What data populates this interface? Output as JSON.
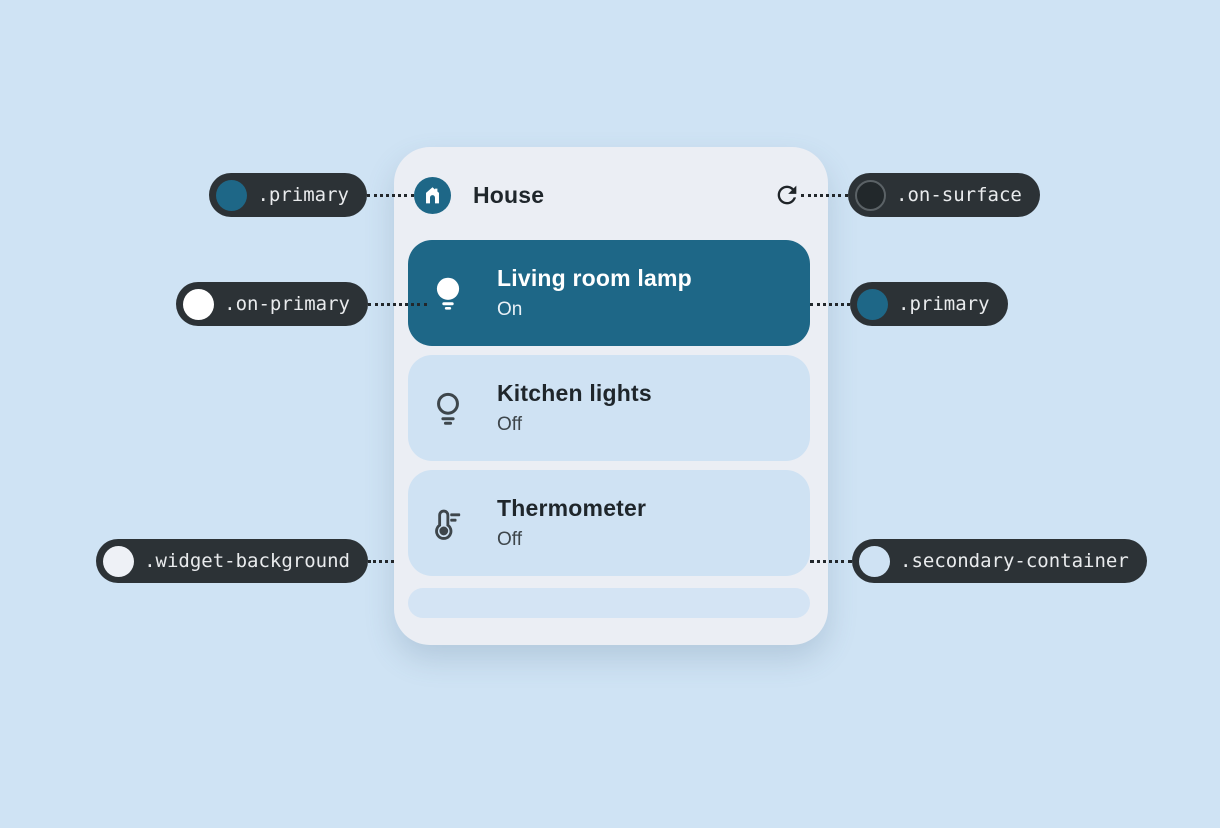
{
  "colors": {
    "page_background": "#cfe3f4",
    "widget_background": "#ebeef4",
    "primary": "#1e6787",
    "on_primary": "#ffffff",
    "secondary_container": "#cfe2f3",
    "on_surface": "#22282b",
    "callout_pill_background": "#2c3236",
    "callout_text": "#e9ebed"
  },
  "widget": {
    "title": "House",
    "header_icon": "house-icon",
    "refresh_icon": "refresh-icon",
    "devices": [
      {
        "name": "Living room lamp",
        "status": "On",
        "icon": "lightbulb-filled-icon",
        "active": true
      },
      {
        "name": "Kitchen lights",
        "status": "Off",
        "icon": "lightbulb-outline-icon",
        "active": false
      },
      {
        "name": "Thermometer",
        "status": "Off",
        "icon": "thermometer-icon",
        "active": false
      }
    ]
  },
  "callouts": [
    {
      "label": ".primary",
      "swatch": "#1e6787",
      "side": "left",
      "row": "top",
      "points_to": "house-icon-badge"
    },
    {
      "label": ".on-surface",
      "swatch": "#22282b",
      "side": "right",
      "row": "top",
      "points_to": "refresh-icon"
    },
    {
      "label": ".on-primary",
      "swatch": "#ffffff",
      "side": "left",
      "row": "middle",
      "points_to": "lightbulb-filled-icon"
    },
    {
      "label": ".primary",
      "swatch": "#1e6787",
      "side": "right",
      "row": "middle",
      "points_to": "active-device-card"
    },
    {
      "label": ".widget-background",
      "swatch": "#eef1f6",
      "side": "left",
      "row": "bottom",
      "points_to": "widget-surface"
    },
    {
      "label": ".secondary-container",
      "swatch": "#cfe2f3",
      "side": "right",
      "row": "bottom",
      "points_to": "inactive-device-card"
    }
  ]
}
